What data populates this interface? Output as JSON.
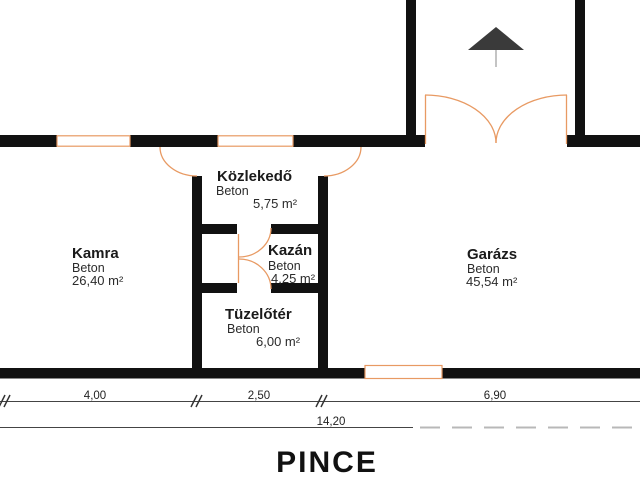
{
  "plan": {
    "title": "PINCE",
    "rooms": [
      {
        "name": "Kamra",
        "floor": "Beton",
        "area": "26,40 m²"
      },
      {
        "name": "Közlekedő",
        "floor": "Beton",
        "area": "5,75 m²"
      },
      {
        "name": "Kazán",
        "floor": "Beton",
        "area": "4,25 m²"
      },
      {
        "name": "Tüzelőtér",
        "floor": "Beton",
        "area": "6,00 m²"
      },
      {
        "name": "Garázs",
        "floor": "Beton",
        "area": "45,54 m²"
      }
    ],
    "dimensions": {
      "segments": [
        "4,00",
        "2,50",
        "6,90"
      ],
      "total": "14,20"
    },
    "colors": {
      "wall": "#111111",
      "joinery": "#e89a63",
      "text": "#1a1a1a",
      "dimension": "#444444",
      "north_arrow": "#3a3a3a"
    }
  }
}
